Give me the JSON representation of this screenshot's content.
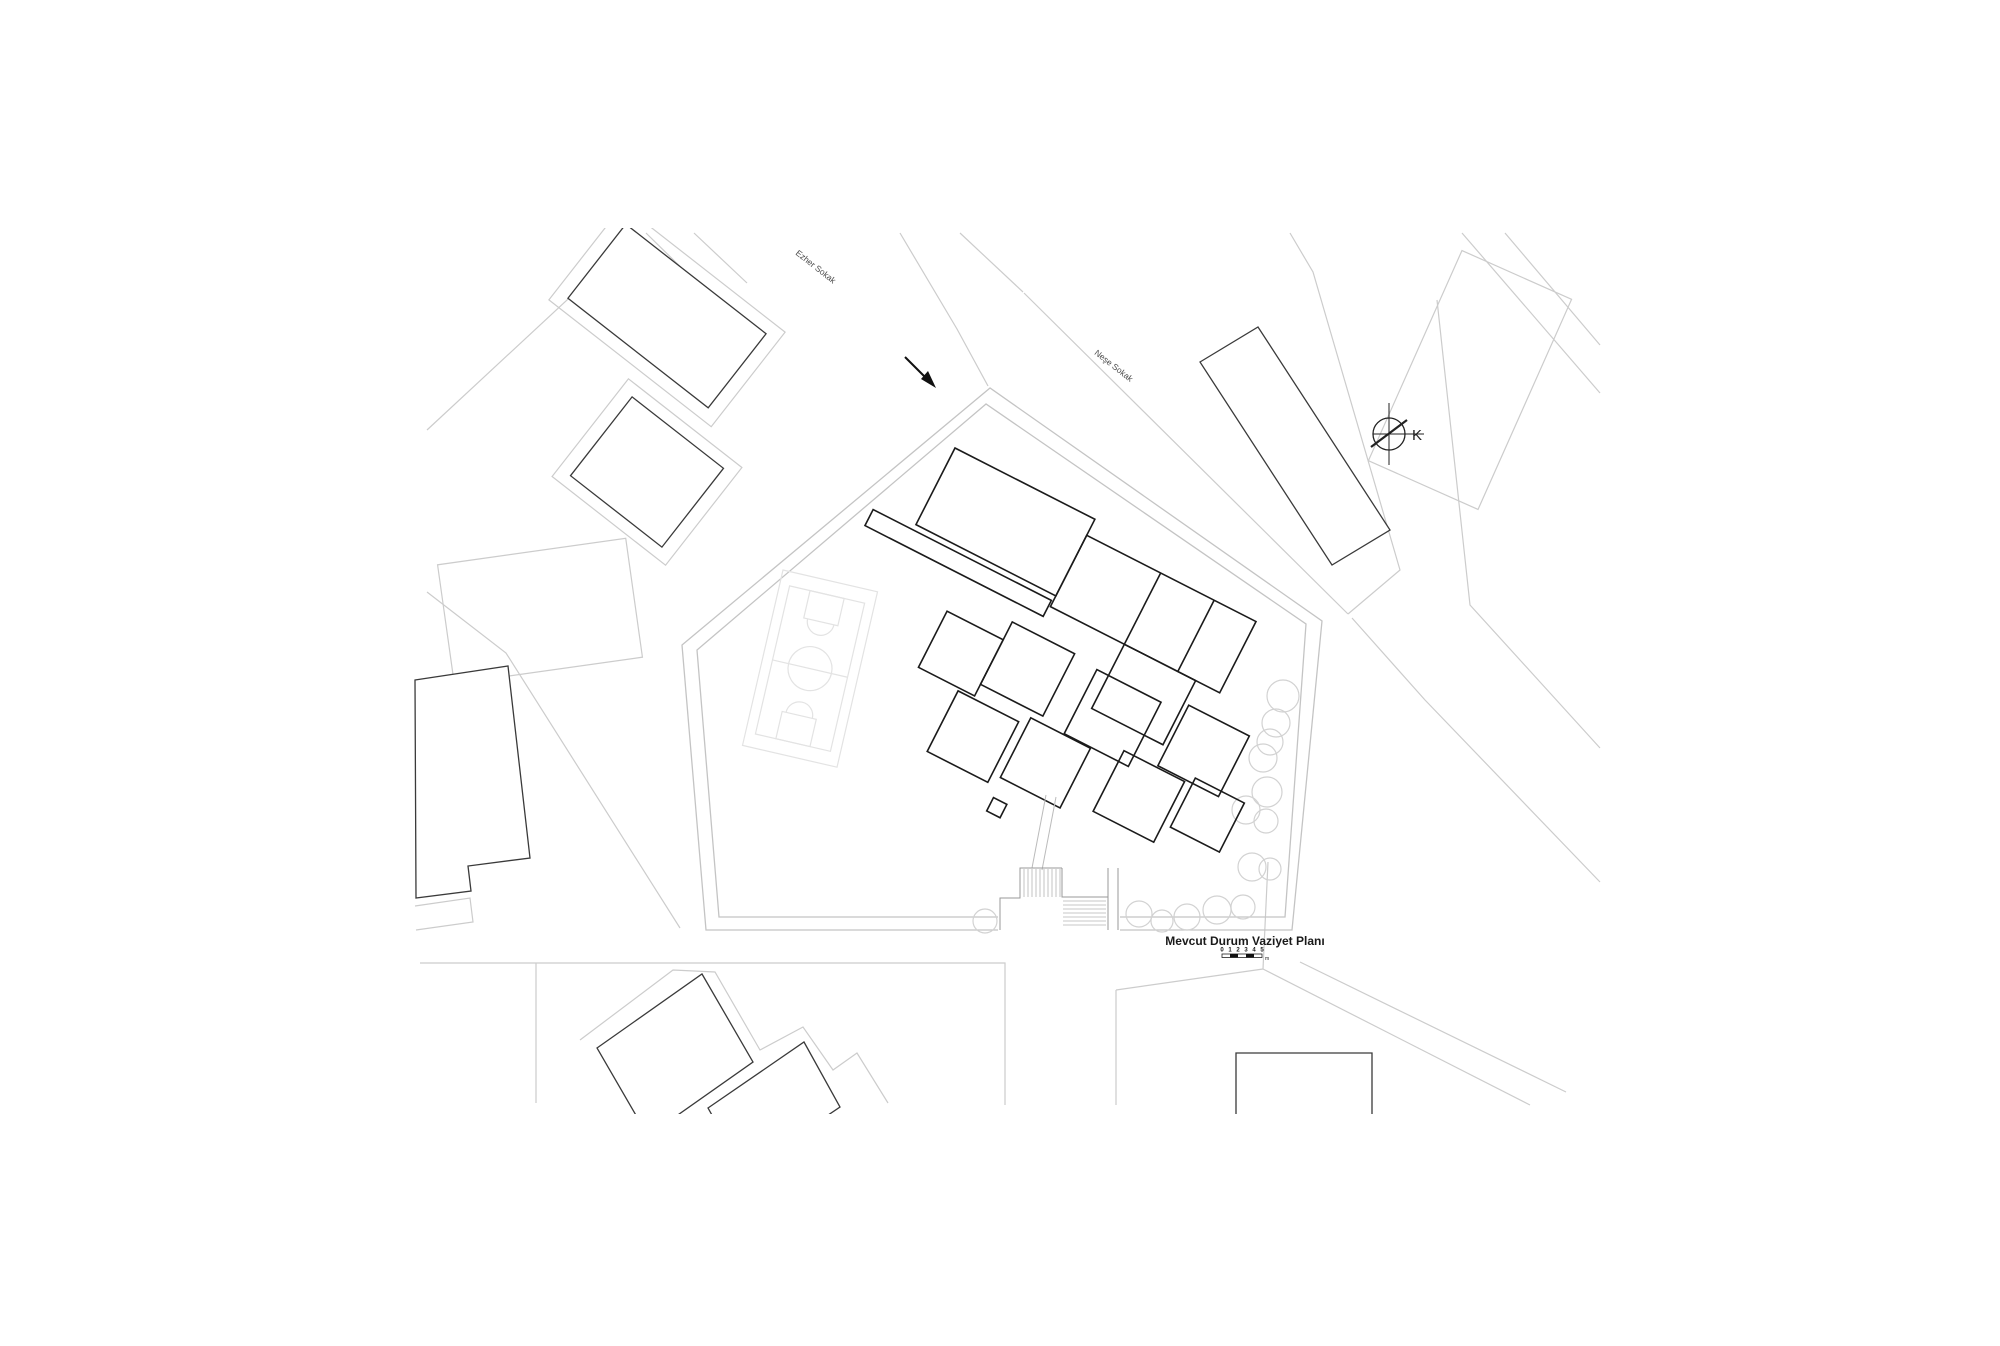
{
  "drawing": {
    "title": "Mevcut Durum Vaziyet Planı",
    "scale_bar": {
      "ticks": [
        "0",
        "1",
        "2",
        "3",
        "4",
        "5"
      ],
      "unit": "m"
    },
    "north_label": "K",
    "streets": [
      {
        "name": "Ezher Sokak"
      },
      {
        "name": "Neşe Sokak"
      }
    ],
    "colors": {
      "background": "#ffffff",
      "building_primary": "#1b1b1b",
      "building_secondary": "#3a3a3a",
      "parcel_line": "#cccccc",
      "boundary_line": "#c4c4c4",
      "court_line": "#e3e3e3",
      "tree_line": "#d2d2d2",
      "stair_line": "#b5b5b5",
      "text": "#333333"
    }
  }
}
